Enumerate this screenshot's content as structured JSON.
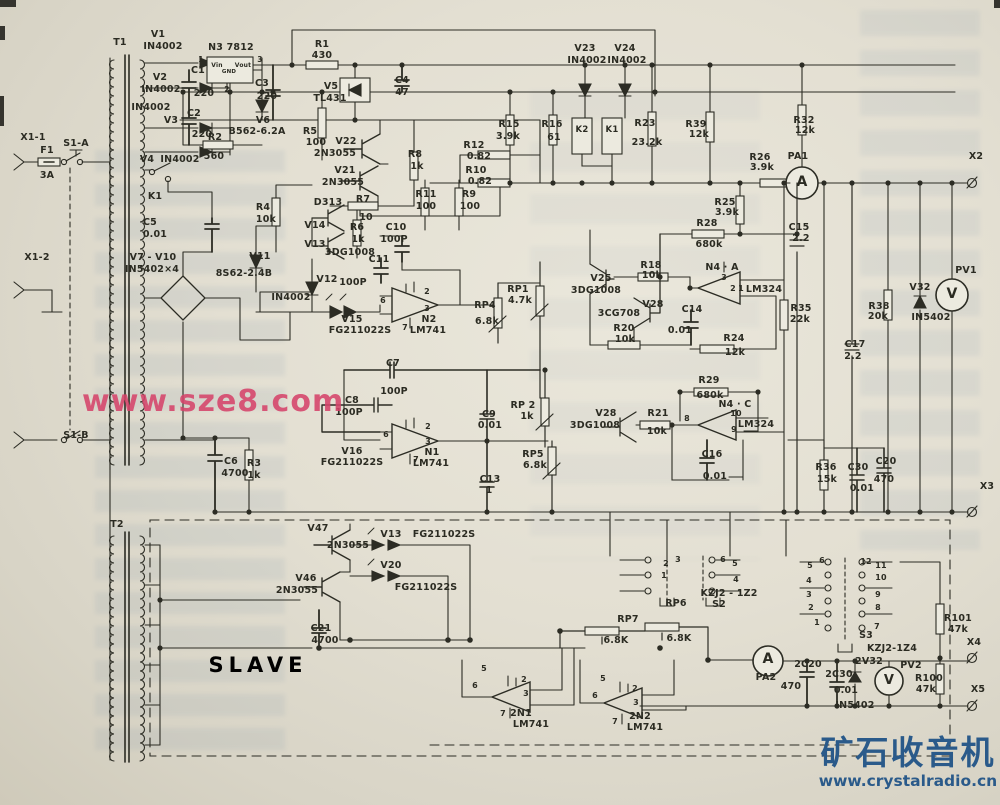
{
  "colors": {
    "paper": "#e3dfd2",
    "ink": "#2b2b22",
    "watermark_pink": "#d6446b",
    "watermark_blue": "#2a5a8a"
  },
  "watermarks": {
    "sze8": "www.sze8.com",
    "crystal_title": "矿石收音机",
    "crystal_url": "www.crystalradio.cn"
  },
  "diagram": {
    "slave_label": "SLAVE",
    "slave_x": 258,
    "slave_y": 655,
    "slave_size": 21
  },
  "labels": [
    {
      "t": "T1",
      "x": 120,
      "y": 38
    },
    {
      "t": "V1",
      "x": 158,
      "y": 30
    },
    {
      "t": "IN4002",
      "x": 163,
      "y": 42
    },
    {
      "t": "V2",
      "x": 160,
      "y": 73
    },
    {
      "t": "IN4002",
      "x": 161,
      "y": 85
    },
    {
      "t": "IN4002",
      "x": 151,
      "y": 103
    },
    {
      "t": "V3",
      "x": 171,
      "y": 116
    },
    {
      "t": "C1",
      "x": 198,
      "y": 66
    },
    {
      "t": "220",
      "x": 204,
      "y": 89
    },
    {
      "t": "C2",
      "x": 194,
      "y": 109
    },
    {
      "t": "220",
      "x": 202,
      "y": 130
    },
    {
      "t": "N3  7812",
      "x": 231,
      "y": 43
    },
    {
      "t": "Vin",
      "x": 217,
      "y": 63,
      "s": 6
    },
    {
      "t": "GND",
      "x": 229,
      "y": 70,
      "s": 5.5
    },
    {
      "t": "Vout",
      "x": 243,
      "y": 63,
      "s": 6
    },
    {
      "t": "1",
      "x": 201,
      "y": 56,
      "s": 7.5
    },
    {
      "t": "3",
      "x": 260,
      "y": 56,
      "s": 7.5
    },
    {
      "t": "2",
      "x": 227,
      "y": 86,
      "s": 7.5
    },
    {
      "t": "C3",
      "x": 262,
      "y": 79
    },
    {
      "t": "220",
      "x": 267,
      "y": 92
    },
    {
      "t": "R1",
      "x": 322,
      "y": 40
    },
    {
      "t": "430",
      "x": 322,
      "y": 51
    },
    {
      "t": "V5",
      "x": 331,
      "y": 82
    },
    {
      "t": "TL431",
      "x": 330,
      "y": 94
    },
    {
      "t": "C4",
      "x": 402,
      "y": 76
    },
    {
      "t": "47",
      "x": 402,
      "y": 88
    },
    {
      "t": "V6",
      "x": 263,
      "y": 116
    },
    {
      "t": "B562-6.2A",
      "x": 257,
      "y": 127
    },
    {
      "t": "R2",
      "x": 215,
      "y": 133
    },
    {
      "t": "560",
      "x": 214,
      "y": 152
    },
    {
      "t": "R5",
      "x": 310,
      "y": 127
    },
    {
      "t": "100",
      "x": 316,
      "y": 138
    },
    {
      "t": "V22",
      "x": 346,
      "y": 137
    },
    {
      "t": "2N3055",
      "x": 335,
      "y": 149
    },
    {
      "t": "V21",
      "x": 345,
      "y": 166
    },
    {
      "t": "2N3055",
      "x": 343,
      "y": 178
    },
    {
      "t": "X1-1",
      "x": 33,
      "y": 133
    },
    {
      "t": "F1",
      "x": 47,
      "y": 146
    },
    {
      "t": "3A",
      "x": 47,
      "y": 171
    },
    {
      "t": "S1-A",
      "x": 76,
      "y": 139
    },
    {
      "t": "V4",
      "x": 147,
      "y": 155
    },
    {
      "t": "IN4002",
      "x": 180,
      "y": 155
    },
    {
      "t": "K1",
      "x": 155,
      "y": 192
    },
    {
      "t": "C5",
      "x": 150,
      "y": 218
    },
    {
      "t": "0.01",
      "x": 155,
      "y": 230
    },
    {
      "t": "V7 - V10",
      "x": 153,
      "y": 253
    },
    {
      "t": "IN5402×4",
      "x": 152,
      "y": 265
    },
    {
      "t": "X1-2",
      "x": 37,
      "y": 253
    },
    {
      "t": "V11",
      "x": 260,
      "y": 252
    },
    {
      "t": "8S62-2.4B",
      "x": 244,
      "y": 269
    },
    {
      "t": "R4",
      "x": 263,
      "y": 203
    },
    {
      "t": "10k",
      "x": 266,
      "y": 215
    },
    {
      "t": "D313",
      "x": 328,
      "y": 198
    },
    {
      "t": "R7",
      "x": 363,
      "y": 195
    },
    {
      "t": "10",
      "x": 366,
      "y": 213
    },
    {
      "t": "V14",
      "x": 315,
      "y": 221
    },
    {
      "t": "R6",
      "x": 357,
      "y": 223
    },
    {
      "t": "1k",
      "x": 358,
      "y": 235
    },
    {
      "t": "V13",
      "x": 315,
      "y": 240
    },
    {
      "t": "3DG1008",
      "x": 350,
      "y": 248
    },
    {
      "t": "C10",
      "x": 396,
      "y": 223
    },
    {
      "t": "100P",
      "x": 394,
      "y": 235
    },
    {
      "t": "C11",
      "x": 379,
      "y": 255
    },
    {
      "t": "V12",
      "x": 327,
      "y": 275
    },
    {
      "t": "100P",
      "x": 353,
      "y": 278
    },
    {
      "t": "IN4002",
      "x": 291,
      "y": 293
    },
    {
      "t": "V15",
      "x": 352,
      "y": 315
    },
    {
      "t": "FG211022S",
      "x": 360,
      "y": 326
    },
    {
      "t": "N2",
      "x": 429,
      "y": 315
    },
    {
      "t": "LM741",
      "x": 428,
      "y": 326
    },
    {
      "t": "6",
      "x": 383,
      "y": 297,
      "s": 8
    },
    {
      "t": "2",
      "x": 427,
      "y": 288,
      "s": 8
    },
    {
      "t": "3",
      "x": 427,
      "y": 305,
      "s": 8
    },
    {
      "t": "7",
      "x": 405,
      "y": 324,
      "s": 8
    },
    {
      "t": "RP4",
      "x": 485,
      "y": 301
    },
    {
      "t": "6.8k",
      "x": 487,
      "y": 317
    },
    {
      "t": "RP1",
      "x": 518,
      "y": 285
    },
    {
      "t": "4.7k",
      "x": 520,
      "y": 296
    },
    {
      "t": "R8",
      "x": 415,
      "y": 150
    },
    {
      "t": "1k",
      "x": 417,
      "y": 162
    },
    {
      "t": "R11",
      "x": 426,
      "y": 190
    },
    {
      "t": "100",
      "x": 426,
      "y": 202
    },
    {
      "t": "R9",
      "x": 469,
      "y": 190
    },
    {
      "t": "100",
      "x": 470,
      "y": 202
    },
    {
      "t": "R12",
      "x": 474,
      "y": 141
    },
    {
      "t": "0.82",
      "x": 479,
      "y": 152
    },
    {
      "t": "R10",
      "x": 476,
      "y": 166
    },
    {
      "t": "0.82",
      "x": 480,
      "y": 177
    },
    {
      "t": "V23",
      "x": 585,
      "y": 44
    },
    {
      "t": "IN4002",
      "x": 587,
      "y": 56
    },
    {
      "t": "V24",
      "x": 625,
      "y": 44
    },
    {
      "t": "IN4002",
      "x": 627,
      "y": 56
    },
    {
      "t": "R15",
      "x": 509,
      "y": 120
    },
    {
      "t": "3.9k",
      "x": 508,
      "y": 132
    },
    {
      "t": "R16",
      "x": 552,
      "y": 120
    },
    {
      "t": "61",
      "x": 554,
      "y": 133
    },
    {
      "t": "K2",
      "x": 582,
      "y": 126,
      "s": 8.5
    },
    {
      "t": "K1",
      "x": 612,
      "y": 126,
      "s": 8.5
    },
    {
      "t": "R23",
      "x": 645,
      "y": 119
    },
    {
      "t": "23.2k",
      "x": 647,
      "y": 138
    },
    {
      "t": "R39",
      "x": 696,
      "y": 120
    },
    {
      "t": "12k",
      "x": 699,
      "y": 130
    },
    {
      "t": "R26",
      "x": 760,
      "y": 153
    },
    {
      "t": "3.9k",
      "x": 762,
      "y": 163
    },
    {
      "t": "PA1",
      "x": 798,
      "y": 152
    },
    {
      "t": "A",
      "x": 802,
      "y": 175,
      "s": 14
    },
    {
      "t": "X2",
      "x": 976,
      "y": 152
    },
    {
      "t": "R32",
      "x": 804,
      "y": 116
    },
    {
      "t": "12k",
      "x": 805,
      "y": 126
    },
    {
      "t": "R25",
      "x": 725,
      "y": 198
    },
    {
      "t": "3.9k",
      "x": 727,
      "y": 208
    },
    {
      "t": "R28",
      "x": 707,
      "y": 219
    },
    {
      "t": "680k",
      "x": 709,
      "y": 240
    },
    {
      "t": "C15",
      "x": 799,
      "y": 223
    },
    {
      "t": "2.2",
      "x": 801,
      "y": 234
    },
    {
      "t": "N4 · A",
      "x": 722,
      "y": 263
    },
    {
      "t": "3",
      "x": 724,
      "y": 274,
      "s": 8
    },
    {
      "t": "2",
      "x": 733,
      "y": 285,
      "s": 8
    },
    {
      "t": "1",
      "x": 741,
      "y": 285,
      "s": 8
    },
    {
      "t": "LM324",
      "x": 764,
      "y": 285
    },
    {
      "t": "V25",
      "x": 601,
      "y": 274
    },
    {
      "t": "3DG1008",
      "x": 596,
      "y": 286
    },
    {
      "t": "R18",
      "x": 651,
      "y": 261
    },
    {
      "t": "10k",
      "x": 652,
      "y": 271
    },
    {
      "t": "V28",
      "x": 653,
      "y": 300
    },
    {
      "t": "3CG708",
      "x": 619,
      "y": 309
    },
    {
      "t": "R20",
      "x": 624,
      "y": 324
    },
    {
      "t": "10k",
      "x": 625,
      "y": 335
    },
    {
      "t": "C14",
      "x": 692,
      "y": 305
    },
    {
      "t": "0.01",
      "x": 680,
      "y": 326
    },
    {
      "t": "R24",
      "x": 734,
      "y": 334
    },
    {
      "t": "12k",
      "x": 735,
      "y": 348
    },
    {
      "t": "R35",
      "x": 801,
      "y": 304
    },
    {
      "t": "22k",
      "x": 800,
      "y": 315
    },
    {
      "t": "C17",
      "x": 855,
      "y": 340
    },
    {
      "t": "2.2",
      "x": 853,
      "y": 352
    },
    {
      "t": "R38",
      "x": 879,
      "y": 302
    },
    {
      "t": "20k",
      "x": 878,
      "y": 312
    },
    {
      "t": "V32",
      "x": 920,
      "y": 283
    },
    {
      "t": "IN5402",
      "x": 931,
      "y": 313
    },
    {
      "t": "PV1",
      "x": 966,
      "y": 266
    },
    {
      "t": "V",
      "x": 952,
      "y": 287,
      "s": 14
    },
    {
      "t": "C7",
      "x": 393,
      "y": 359
    },
    {
      "t": "100P",
      "x": 394,
      "y": 387
    },
    {
      "t": "C8",
      "x": 352,
      "y": 396
    },
    {
      "t": "100P",
      "x": 349,
      "y": 408
    },
    {
      "t": "V16",
      "x": 352,
      "y": 447
    },
    {
      "t": "FG211022S",
      "x": 352,
      "y": 458
    },
    {
      "t": "N1",
      "x": 432,
      "y": 448
    },
    {
      "t": "LM741",
      "x": 431,
      "y": 459
    },
    {
      "t": "6",
      "x": 386,
      "y": 431,
      "s": 8
    },
    {
      "t": "2",
      "x": 428,
      "y": 423,
      "s": 8
    },
    {
      "t": "3",
      "x": 428,
      "y": 438,
      "s": 8
    },
    {
      "t": "7",
      "x": 416,
      "y": 456,
      "s": 8
    },
    {
      "t": "C9",
      "x": 489,
      "y": 410
    },
    {
      "t": "0.01",
      "x": 490,
      "y": 421
    },
    {
      "t": "RP 2",
      "x": 523,
      "y": 401
    },
    {
      "t": "1k",
      "x": 527,
      "y": 412
    },
    {
      "t": "RP5",
      "x": 533,
      "y": 450
    },
    {
      "t": "6.8k",
      "x": 535,
      "y": 461
    },
    {
      "t": "C13",
      "x": 490,
      "y": 475
    },
    {
      "t": "1",
      "x": 489,
      "y": 486
    },
    {
      "t": "R29",
      "x": 709,
      "y": 376
    },
    {
      "t": "680k",
      "x": 710,
      "y": 391
    },
    {
      "t": "V28",
      "x": 606,
      "y": 409
    },
    {
      "t": "3DG1008",
      "x": 595,
      "y": 421
    },
    {
      "t": "R21",
      "x": 658,
      "y": 409
    },
    {
      "t": "10k",
      "x": 657,
      "y": 427
    },
    {
      "t": "N4 · C",
      "x": 735,
      "y": 400
    },
    {
      "t": "10",
      "x": 736,
      "y": 410,
      "s": 8
    },
    {
      "t": "8",
      "x": 687,
      "y": 415,
      "s": 8
    },
    {
      "t": "9",
      "x": 734,
      "y": 426,
      "s": 8
    },
    {
      "t": "LM324",
      "x": 756,
      "y": 420
    },
    {
      "t": "C16",
      "x": 712,
      "y": 450
    },
    {
      "t": "0.01",
      "x": 715,
      "y": 472
    },
    {
      "t": "R36",
      "x": 826,
      "y": 463
    },
    {
      "t": "15k",
      "x": 827,
      "y": 475
    },
    {
      "t": "C30",
      "x": 858,
      "y": 463
    },
    {
      "t": "0.01",
      "x": 862,
      "y": 484
    },
    {
      "t": "C20",
      "x": 886,
      "y": 457
    },
    {
      "t": "470",
      "x": 884,
      "y": 475
    },
    {
      "t": "X3",
      "x": 987,
      "y": 482
    },
    {
      "t": "C6",
      "x": 231,
      "y": 457
    },
    {
      "t": "4700",
      "x": 235,
      "y": 469
    },
    {
      "t": "R3",
      "x": 254,
      "y": 459
    },
    {
      "t": "1k",
      "x": 254,
      "y": 471
    },
    {
      "t": "S1-B",
      "x": 76,
      "y": 431
    },
    {
      "t": "T2",
      "x": 117,
      "y": 520
    },
    {
      "t": "V47",
      "x": 318,
      "y": 524
    },
    {
      "t": "2N3055",
      "x": 348,
      "y": 541
    },
    {
      "t": "V46",
      "x": 306,
      "y": 574
    },
    {
      "t": "2N3055",
      "x": 297,
      "y": 586
    },
    {
      "t": "V13",
      "x": 391,
      "y": 530
    },
    {
      "t": "FG211022S",
      "x": 444,
      "y": 530
    },
    {
      "t": "V20",
      "x": 391,
      "y": 561
    },
    {
      "t": "FG211022S",
      "x": 426,
      "y": 583
    },
    {
      "t": "C21",
      "x": 321,
      "y": 624
    },
    {
      "t": "4700",
      "x": 325,
      "y": 636
    },
    {
      "t": "2",
      "x": 666,
      "y": 560,
      "s": 8
    },
    {
      "t": "3",
      "x": 678,
      "y": 556,
      "s": 8
    },
    {
      "t": "1",
      "x": 664,
      "y": 572,
      "s": 8
    },
    {
      "t": "6",
      "x": 723,
      "y": 556,
      "s": 8
    },
    {
      "t": "5",
      "x": 735,
      "y": 560,
      "s": 8
    },
    {
      "t": "4",
      "x": 736,
      "y": 576,
      "s": 8
    },
    {
      "t": "KZJ2 - 1Z2",
      "x": 729,
      "y": 589
    },
    {
      "t": "S2",
      "x": 719,
      "y": 600
    },
    {
      "t": "RP6",
      "x": 676,
      "y": 599
    },
    {
      "t": "6.8K",
      "x": 679,
      "y": 634
    },
    {
      "t": "RP7",
      "x": 628,
      "y": 615
    },
    {
      "t": "6.8K",
      "x": 616,
      "y": 636
    },
    {
      "t": "PA2",
      "x": 766,
      "y": 673
    },
    {
      "t": "A",
      "x": 768,
      "y": 652,
      "s": 14
    },
    {
      "t": "5",
      "x": 810,
      "y": 562,
      "s": 8
    },
    {
      "t": "6",
      "x": 822,
      "y": 557,
      "s": 8
    },
    {
      "t": "4",
      "x": 809,
      "y": 577,
      "s": 8
    },
    {
      "t": "3",
      "x": 809,
      "y": 591,
      "s": 8
    },
    {
      "t": "2",
      "x": 811,
      "y": 604,
      "s": 8
    },
    {
      "t": "1",
      "x": 817,
      "y": 619,
      "s": 8
    },
    {
      "t": "12",
      "x": 866,
      "y": 558,
      "s": 8
    },
    {
      "t": "11",
      "x": 881,
      "y": 562,
      "s": 8
    },
    {
      "t": "10",
      "x": 881,
      "y": 574,
      "s": 8
    },
    {
      "t": "9",
      "x": 878,
      "y": 591,
      "s": 8
    },
    {
      "t": "8",
      "x": 878,
      "y": 604,
      "s": 8
    },
    {
      "t": "7",
      "x": 877,
      "y": 623,
      "s": 8
    },
    {
      "t": "S3",
      "x": 866,
      "y": 631
    },
    {
      "t": "KZJ2-1Z4",
      "x": 892,
      "y": 644
    },
    {
      "t": "2C20",
      "x": 808,
      "y": 660
    },
    {
      "t": "470",
      "x": 791,
      "y": 682
    },
    {
      "t": "2C30",
      "x": 839,
      "y": 670
    },
    {
      "t": "0.01",
      "x": 846,
      "y": 686
    },
    {
      "t": "2V32",
      "x": 869,
      "y": 657
    },
    {
      "t": "PV2",
      "x": 911,
      "y": 661
    },
    {
      "t": "V",
      "x": 889,
      "y": 674,
      "s": 13
    },
    {
      "t": "R101",
      "x": 958,
      "y": 614
    },
    {
      "t": "47k",
      "x": 958,
      "y": 625
    },
    {
      "t": "X4",
      "x": 974,
      "y": 638
    },
    {
      "t": "R100",
      "x": 929,
      "y": 674
    },
    {
      "t": "47k",
      "x": 926,
      "y": 685
    },
    {
      "t": "X5",
      "x": 978,
      "y": 685
    },
    {
      "t": "IN5402",
      "x": 855,
      "y": 701
    },
    {
      "t": "2N1",
      "x": 521,
      "y": 709
    },
    {
      "t": "LM741",
      "x": 531,
      "y": 720
    },
    {
      "t": "6",
      "x": 475,
      "y": 682,
      "s": 8
    },
    {
      "t": "2",
      "x": 524,
      "y": 676,
      "s": 8
    },
    {
      "t": "3",
      "x": 526,
      "y": 690,
      "s": 8
    },
    {
      "t": "7",
      "x": 503,
      "y": 710,
      "s": 8
    },
    {
      "t": "5",
      "x": 484,
      "y": 665,
      "s": 8
    },
    {
      "t": "2N2",
      "x": 640,
      "y": 712
    },
    {
      "t": "LM741",
      "x": 645,
      "y": 723
    },
    {
      "t": "6",
      "x": 595,
      "y": 692,
      "s": 8
    },
    {
      "t": "2",
      "x": 635,
      "y": 685,
      "s": 8
    },
    {
      "t": "3",
      "x": 636,
      "y": 699,
      "s": 8
    },
    {
      "t": "7",
      "x": 615,
      "y": 718,
      "s": 8
    },
    {
      "t": "5",
      "x": 603,
      "y": 675,
      "s": 8
    }
  ]
}
